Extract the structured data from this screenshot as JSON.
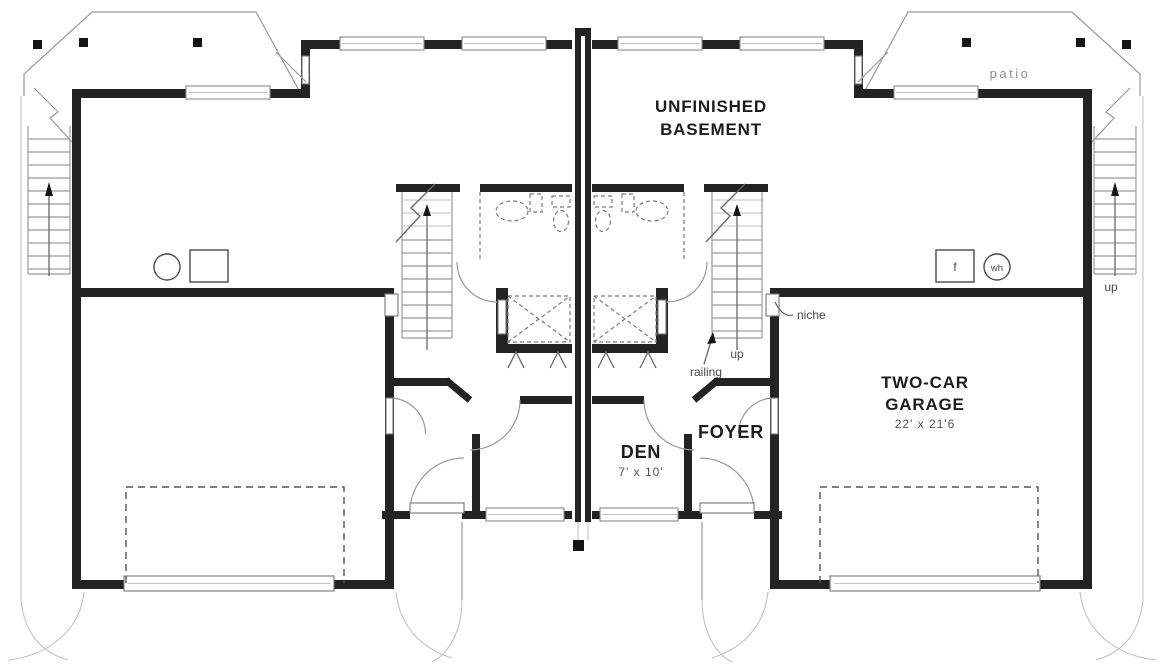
{
  "labels": {
    "basement_line1": "UNFINISHED",
    "basement_line2": "BASEMENT",
    "patio": "patio",
    "garage_line1": "TWO-CAR",
    "garage_line2": "GARAGE",
    "garage_dims": "22' x 21'6",
    "den": "DEN",
    "den_dims": "7' x 10'",
    "foyer": "FOYER",
    "niche": "niche",
    "railing": "railing",
    "stair_up": "up",
    "exterior_stair_up": "up",
    "furnace": "f",
    "water_heater": "wh"
  },
  "colors": {
    "wall": "#232323",
    "line-mid": "#666666",
    "line-light": "#9a9a9a",
    "text-dark": "#1c1c1c",
    "text-dim": "#555555",
    "text-faint": "#8f8f8f",
    "paper": "#ffffff"
  }
}
